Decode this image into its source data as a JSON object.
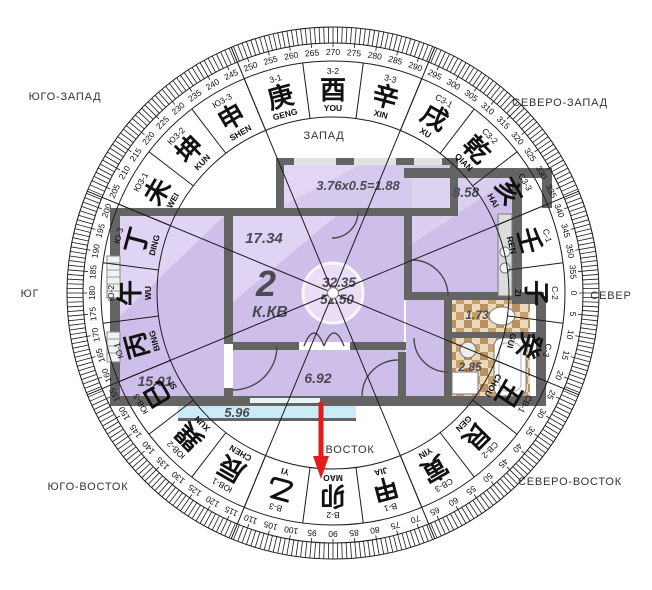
{
  "compass": {
    "center": {
      "x": 333,
      "y": 293
    },
    "colors": {
      "line": "#1c1c1c",
      "text": "#111111",
      "direction_text": "#333333",
      "arrow": "#e31b1b"
    },
    "rings": {
      "outer_r": 266,
      "tick_inner_r": 250,
      "tick_major_inner_r": 246,
      "band_outer_r": 232,
      "band_inner_r": 176,
      "degree_label_r": 241,
      "code_r": 222,
      "hanzi_r": 203,
      "pinyin_r": 185
    },
    "degree_labels": {
      "start": 0,
      "end": 355,
      "step": 5
    },
    "cross_angles": [
      22.5,
      67.5,
      112.5,
      157.5
    ],
    "sectors": [
      {
        "code": "С-1",
        "hanzi": "壬",
        "pinyin": "REN",
        "deg": 345
      },
      {
        "code": "С-2",
        "hanzi": "子",
        "pinyin": "ZI",
        "deg": 0
      },
      {
        "code": "С-3",
        "hanzi": "癸",
        "pinyin": "GUI",
        "deg": 15
      },
      {
        "code": "СВ-1",
        "hanzi": "丑",
        "pinyin": "CHOU",
        "deg": 30
      },
      {
        "code": "СВ-2",
        "hanzi": "艮",
        "pinyin": "GEN",
        "deg": 45
      },
      {
        "code": "СВ-3",
        "hanzi": "寅",
        "pinyin": "YIN",
        "deg": 60
      },
      {
        "code": "В-1",
        "hanzi": "甲",
        "pinyin": "JIA",
        "deg": 75
      },
      {
        "code": "В-2",
        "hanzi": "卯",
        "pinyin": "MAO",
        "deg": 90
      },
      {
        "code": "В-3",
        "hanzi": "乙",
        "pinyin": "YI",
        "deg": 105
      },
      {
        "code": "ЮВ-1",
        "hanzi": "辰",
        "pinyin": "CHEN",
        "deg": 120
      },
      {
        "code": "ЮВ-2",
        "hanzi": "巽",
        "pinyin": "XUN",
        "deg": 135
      },
      {
        "code": "ЮВ-3",
        "hanzi": "巳",
        "pinyin": "SI",
        "deg": 150
      },
      {
        "code": "Ю-1",
        "hanzi": "丙",
        "pinyin": "BING",
        "deg": 165
      },
      {
        "code": "Ю-2",
        "hanzi": "午",
        "pinyin": "WU",
        "deg": 180
      },
      {
        "code": "Ю-3",
        "hanzi": "丁",
        "pinyin": "DING",
        "deg": 195
      },
      {
        "code": "Ю3-1",
        "hanzi": "未",
        "pinyin": "WEI",
        "deg": 210
      },
      {
        "code": "Ю3-2",
        "hanzi": "坤",
        "pinyin": "KUN",
        "deg": 225
      },
      {
        "code": "Ю3-3",
        "hanzi": "申",
        "pinyin": "SHEN",
        "deg": 240
      },
      {
        "code": "3-1",
        "hanzi": "庚",
        "pinyin": "GENG",
        "deg": 255
      },
      {
        "code": "3-2",
        "hanzi": "酉",
        "pinyin": "YOU",
        "deg": 270
      },
      {
        "code": "3-3",
        "hanzi": "辛",
        "pinyin": "XIN",
        "deg": 285
      },
      {
        "code": "С3-1",
        "hanzi": "戌",
        "pinyin": "XU",
        "deg": 300
      },
      {
        "code": "С3-2",
        "hanzi": "乾",
        "pinyin": "QIAN",
        "deg": 315
      },
      {
        "code": "С3-3",
        "hanzi": "亥",
        "pinyin": "HAI",
        "deg": 330
      }
    ],
    "outer_direction_labels": [
      {
        "id": "yugo-zapad",
        "label": "ЮГО-ЗАПАД",
        "x": 65,
        "y": 97
      },
      {
        "id": "severo-zapad",
        "label": "СЕВЕРО-ЗАПАД",
        "x": 560,
        "y": 103
      },
      {
        "id": "yug",
        "label": "ЮГ",
        "x": 30,
        "y": 294
      },
      {
        "id": "sever",
        "label": "СЕВЕР",
        "x": 611,
        "y": 296
      },
      {
        "id": "yugo-vostok",
        "label": "ЮГО-ВОСТОК",
        "x": 88,
        "y": 487
      },
      {
        "id": "severo-vostok",
        "label": "СЕВЕРО-ВОСТОК",
        "x": 570,
        "y": 482
      }
    ],
    "inner_direction_labels": [
      {
        "id": "zapad",
        "label": "ЗАПАД",
        "x": 324,
        "y": 136
      },
      {
        "id": "vostok",
        "label": "ВОСТОК",
        "x": 350,
        "y": 450
      }
    ],
    "facing_arrow": {
      "x": 321,
      "y_start": 402,
      "y_end": 479
    }
  },
  "floorplan": {
    "apartment": {
      "number": "2",
      "type": "К.КВ",
      "area_living": "32.35",
      "area_total": "51.50"
    },
    "labels": {
      "living": "17.34",
      "bedroom": "15.01",
      "hall": "6.92",
      "kitchen": "8.58",
      "wc": "1.73",
      "bath": "2.85",
      "balcony_bottom": "5.96",
      "balcony_top": "3.76x0.5=1.88"
    },
    "colors": {
      "wall": "#646464",
      "room": "#cdbfe9",
      "room_light": "#e4dbf7",
      "balcony": "#c9ecf6",
      "tile_dark": "#bb9160",
      "tile_light": "#ead9bd"
    }
  }
}
